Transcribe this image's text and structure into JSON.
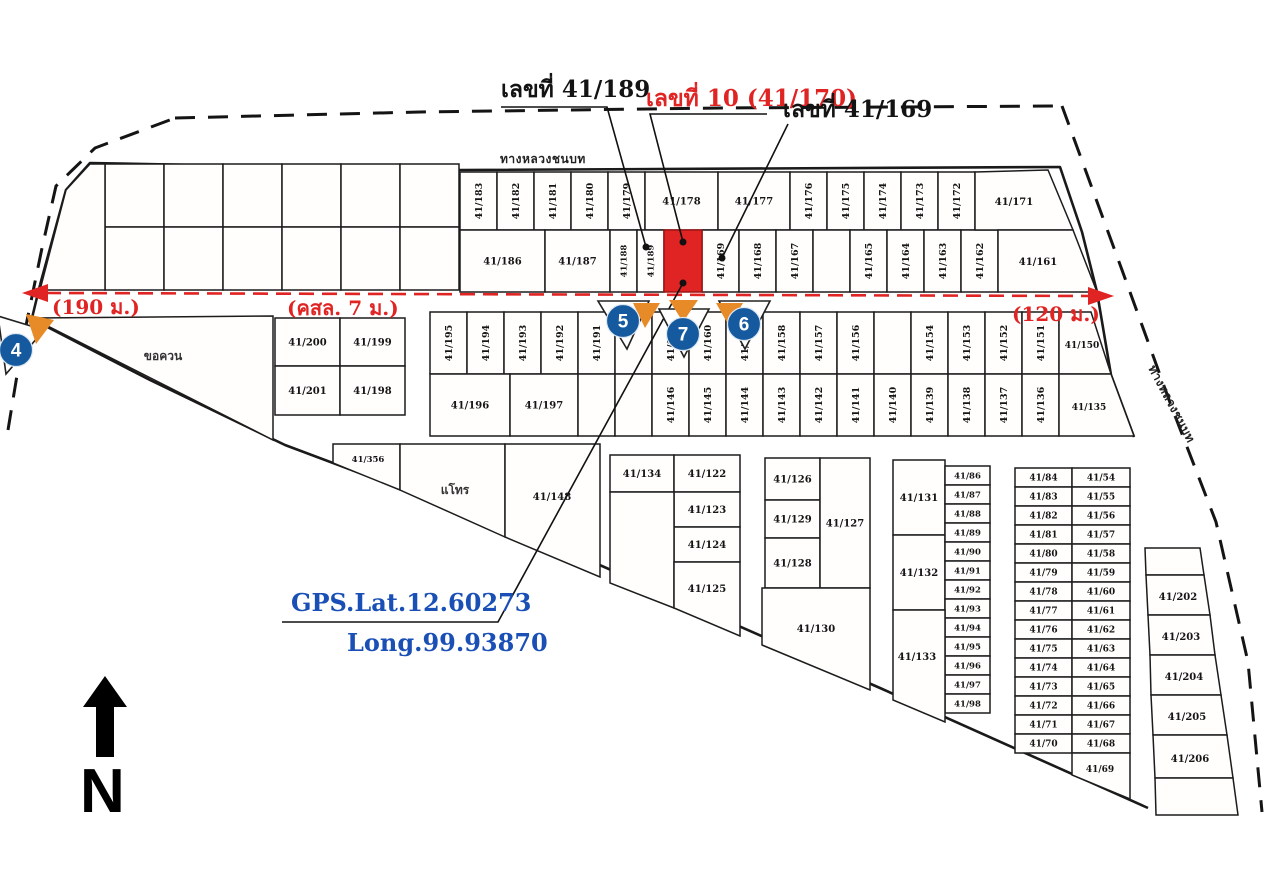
{
  "header_labels": {
    "left": "เลขที่ 41/189",
    "target": "เลขที่ 10 (41/170)",
    "right": "เลขที่ 41/169"
  },
  "gps": {
    "lat": "GPS.Lat.12.60273",
    "long": "Long.99.93870"
  },
  "compass": {
    "north": "N"
  },
  "roads": {
    "top": "ทางหลวงชนบท",
    "right": "ทางหลวงชนบท",
    "dim_west": "(190 ม.)",
    "dim_mid": "(คสล. 7 ม.)",
    "dim_east": "(120 ม.)"
  },
  "areas": {
    "left_area": "ขอควน",
    "mid_area": "แโทร"
  },
  "markers": [
    {
      "number": "4"
    },
    {
      "number": "5"
    },
    {
      "number": "7"
    },
    {
      "number": "6"
    }
  ],
  "target_plot": {
    "number": "41/170",
    "highlight": "#e02423"
  },
  "colors": {
    "highlight_red": "#e02423",
    "marker_blue": "#15599f",
    "marker_orange": "#e78a28",
    "gps_blue": "#1a4fb5",
    "map_line": "#1a1a1a"
  },
  "plots": {
    "row1": [
      "41/183",
      "41/182",
      "41/181",
      "41/180",
      "41/179",
      "41/178",
      "41/177",
      "41/176",
      "41/175",
      "41/174",
      "41/173",
      "41/172",
      "41/171"
    ],
    "row2_left": [
      "41/186",
      "41/187",
      "41/188",
      "41/189"
    ],
    "row2_right": [
      "41/169",
      "41/168",
      "41/167",
      "",
      "41/165",
      "41/164",
      "41/163",
      "41/162",
      "41/161"
    ],
    "row3": [
      "41/195",
      "41/194",
      "41/193",
      "41/192",
      "41/191",
      "",
      "41/190",
      "41/160",
      "41/159",
      "41/158",
      "41/157",
      "41/156",
      "",
      "41/154",
      "41/153",
      "41/152",
      "41/151",
      "41/150"
    ],
    "row4": [
      "41/196",
      "41/197",
      "",
      "",
      "41/146",
      "41/145",
      "41/144",
      "41/143",
      "41/142",
      "41/141",
      "41/140",
      "41/139",
      "41/138",
      "41/137",
      "41/136",
      "41/135"
    ],
    "block_nw": [
      "41/200",
      "41/199",
      "41/201",
      "41/198"
    ],
    "south_west": [
      "41/356",
      "41/148"
    ],
    "block_a": [
      "41/134",
      "41/122",
      "41/123",
      "41/124",
      "41/125"
    ],
    "block_b": [
      "41/126",
      "41/129",
      "41/128",
      "41/127",
      "41/130"
    ],
    "block_c_large": [
      "41/131",
      "41/132",
      "41/133"
    ],
    "block_c_col": [
      "41/86",
      "41/87",
      "41/88",
      "41/89",
      "41/90",
      "41/91",
      "41/92",
      "41/93",
      "41/94",
      "41/95",
      "41/96",
      "41/97",
      "41/98"
    ],
    "block_c_left": [
      "41/84",
      "41/83",
      "41/82",
      "41/81",
      "41/80",
      "41/79",
      "41/78",
      "41/77",
      "41/76",
      "41/75",
      "41/74",
      "41/73",
      "41/72",
      "41/71",
      "41/70"
    ],
    "block_c_right": [
      "41/54",
      "41/55",
      "41/56",
      "41/57",
      "41/58",
      "41/59",
      "41/60",
      "41/61",
      "41/62",
      "41/63",
      "41/64",
      "41/65",
      "41/66",
      "41/67",
      "41/68",
      "41/69"
    ],
    "east_col": [
      "41/202",
      "41/203",
      "41/204",
      "41/205",
      "41/206"
    ]
  }
}
